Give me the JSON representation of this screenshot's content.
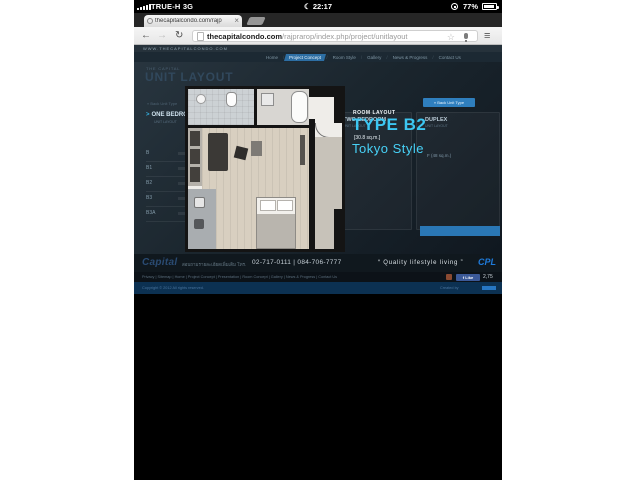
{
  "status_bar": {
    "carrier": "TRUE-H 3G",
    "time": "22:17",
    "battery_percent": "77%"
  },
  "browser": {
    "tab_title": "thecapitalcondo.com/rajp",
    "close_label": "×",
    "url_domain": "thecapitalcondo.com",
    "url_path": "/rajprarop/index.php/project/unitlayout"
  },
  "site": {
    "header_url": "WWW.THECAPITALCONDO.COM",
    "nav": [
      {
        "label": "Home"
      },
      {
        "label": "Project Concept"
      },
      {
        "label": "Room Style"
      },
      {
        "label": "Gallery"
      },
      {
        "label": "News & Progress"
      },
      {
        "label": "Contact Us"
      }
    ],
    "supertitle": "THE CAPITAL",
    "title": "UNIT LAYOUT",
    "back_button": "« Back Unit Type",
    "one_bedroom": {
      "header": "ONE BEDROOM",
      "subtitle": "UNIT LAYOUT",
      "rows": [
        "B",
        "B1",
        "B2",
        "B3",
        "B3A"
      ]
    },
    "two_bedroom_header": "TWO BEDROOM",
    "duplex": {
      "header": "DUPLEX",
      "row": "F  (48 sq.m.)"
    },
    "room": {
      "label": "ROOM LAYOUT",
      "type": "TYPE B2",
      "area": "[30.8 sq.m.]",
      "style": "Tokyo Style"
    },
    "footer": {
      "logo": "Capital",
      "contact_th": "สอบถามรายละเอียดเพิ่มเติม โทร.",
      "phone": "02-717-0111  |  084-706-7777",
      "slogan": "“ Quality lifestyle living ”",
      "brand": "CPL",
      "links": "Privacy | Sitemap | Home | Project Concept | Presentation | Room Concept | Gallery | News & Progress | Contact Us",
      "like_label": "f Like",
      "like_count": "2,75",
      "copyright": "Copyright © 2012 All rights reserved.",
      "credit": "Created by"
    }
  }
}
